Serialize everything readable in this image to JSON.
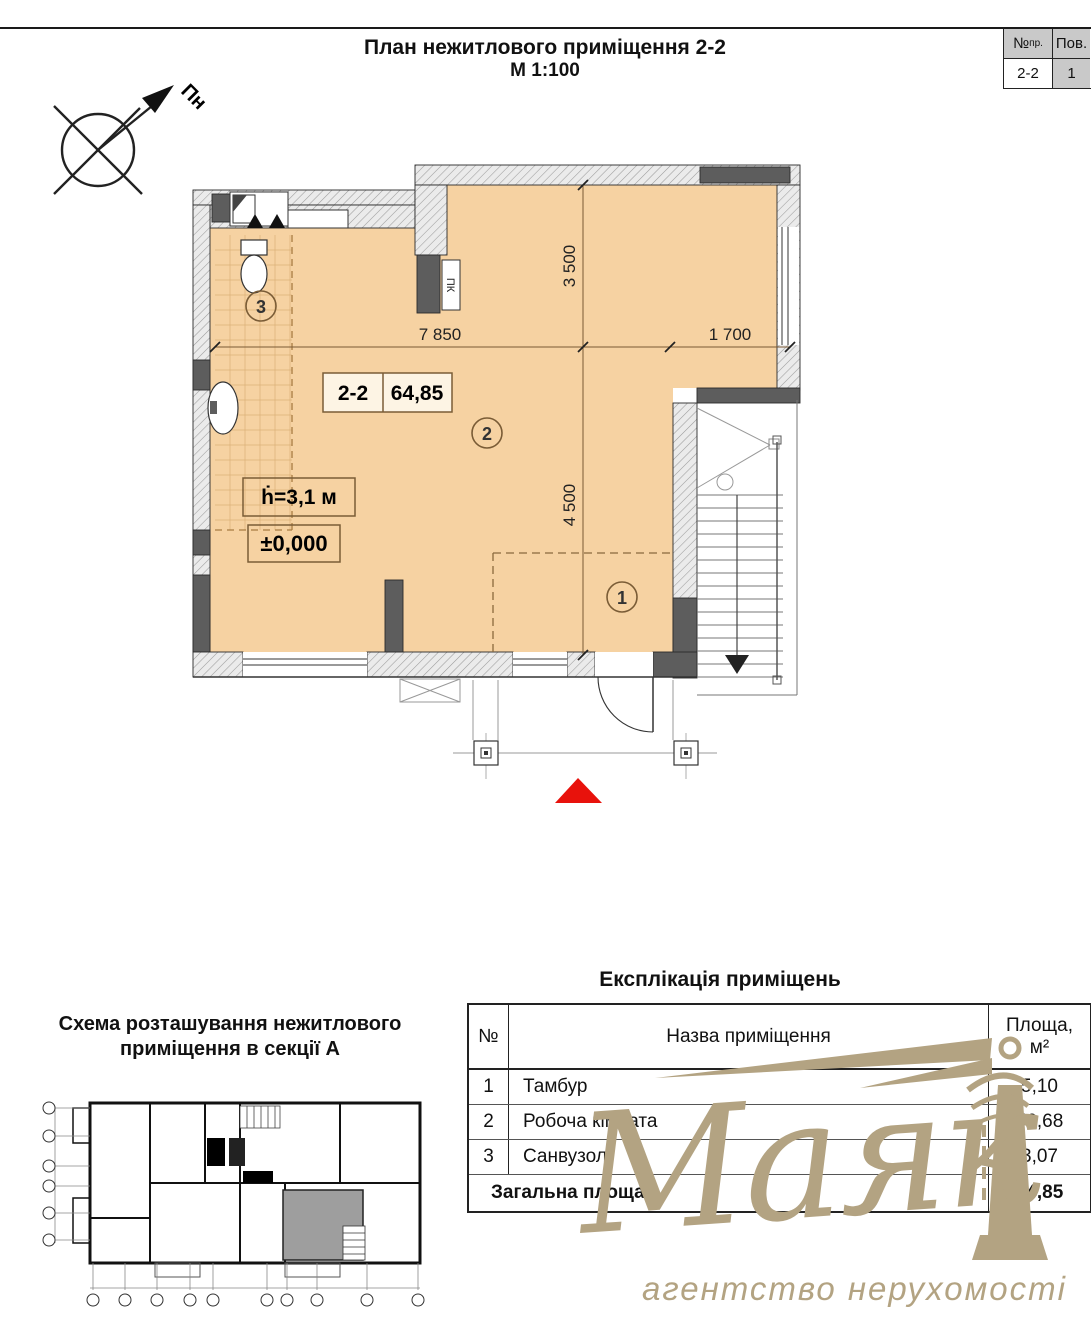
{
  "page_header": {
    "title": "План нежитлового приміщення 2-2",
    "scale": "М 1:100"
  },
  "ref_table": {
    "col_project": "№",
    "col_project_sub": "пр.",
    "col_floor": "Пов.",
    "project_value": "2-2",
    "floor_value": "1"
  },
  "compass": {
    "north": "Пн"
  },
  "plan": {
    "unit_number": "2-2",
    "unit_area": "64,85",
    "ceiling_height": "ḣ=3,1 м",
    "level_mark": "±0,000",
    "duct_label": "ПК",
    "room_marks": [
      "1",
      "2",
      "3"
    ],
    "dims": {
      "v_top": "3 500",
      "v_bottom": "4 500",
      "h_left": "7 850",
      "h_right": "1 700"
    }
  },
  "location_schema": {
    "title_line1": "Схема розташування нежитлового",
    "title_line2": "приміщення в секції А"
  },
  "explication": {
    "title": "Експлікація приміщень",
    "col_num": "№",
    "col_name": "Назва приміщення",
    "col_area_line1": "Площа,",
    "col_area_line2": "м²",
    "rows": [
      {
        "num": "1",
        "name": "Тамбур",
        "area": "5,10"
      },
      {
        "num": "2",
        "name": "Робоча кімната",
        "area": "56,68"
      },
      {
        "num": "3",
        "name": "Санвузол",
        "area": "3,07"
      }
    ],
    "total_label": "Загальна площа",
    "total_area": "64,85"
  },
  "watermark": {
    "brand": "Маяк",
    "subtitle": "агентство нерухомості",
    "color": "#b3a382"
  },
  "colors": {
    "floor": "#f6d2a2",
    "accent_red": "#e8120c"
  }
}
